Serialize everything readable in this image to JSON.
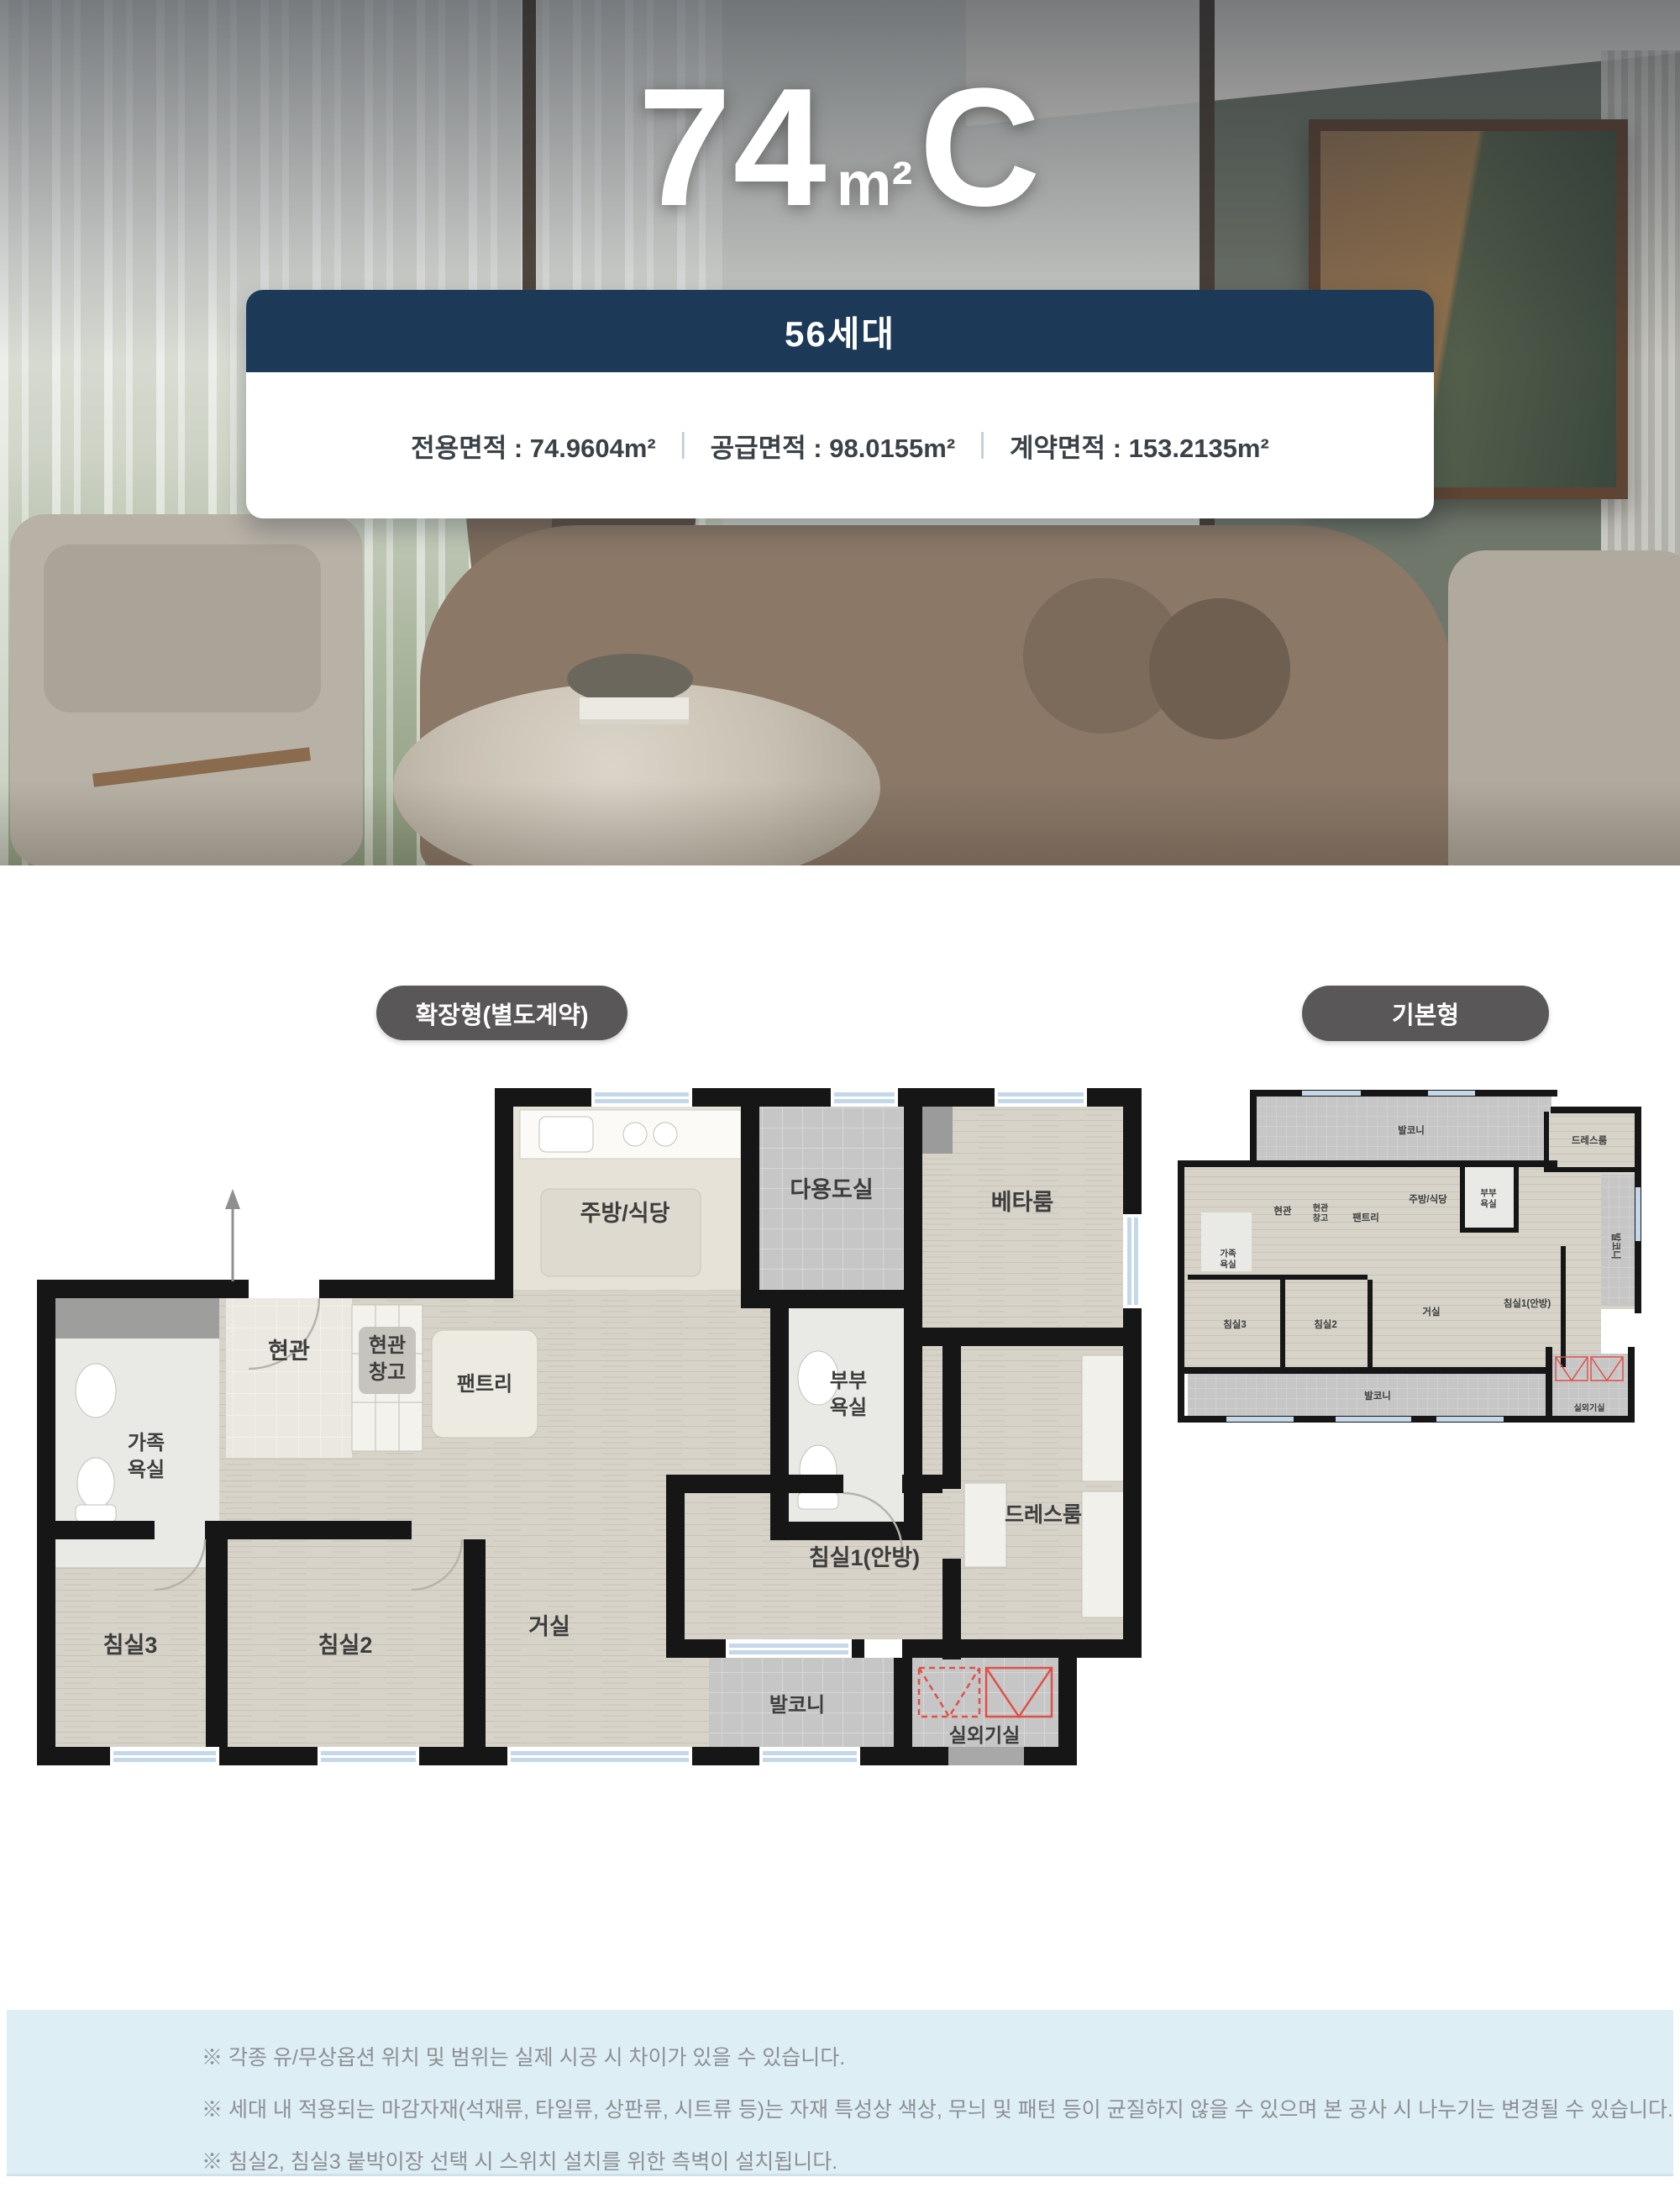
{
  "hero": {
    "unit_number": "74",
    "area_unit": "m²",
    "unit_letter": "C",
    "badge": "56세대",
    "area_exclusive": "전용면적 : 74.9604m²",
    "area_supply": "공급면적 : 98.0155m²",
    "area_contract": "계약면적 : 153.2135m²",
    "separator": "|"
  },
  "plans": {
    "expanded": {
      "badge": "확장형(별도계약)",
      "rooms": {
        "entry": "현관",
        "entry_storage_l1": "현관",
        "entry_storage_l2": "창고",
        "pantry": "팬트리",
        "family_bath_l1": "가족",
        "family_bath_l2": "욕실",
        "kitchen": "주방/식당",
        "utility": "다용도실",
        "beta_room": "베타룸",
        "master_bath_l1": "부부",
        "master_bath_l2": "욕실",
        "dress_room": "드레스룸",
        "bedroom1": "침실1(안방)",
        "living": "거실",
        "bedroom2": "침실2",
        "bedroom3": "침실3",
        "balcony": "발코니",
        "outdoor_unit": "실외기실"
      }
    },
    "basic": {
      "badge": "기본형",
      "rooms": {
        "balcony_top": "발코니",
        "dress_room": "드레스룸",
        "kitchen": "주방/식당",
        "master_bath_l1": "부부",
        "master_bath_l2": "욕실",
        "entry": "현관",
        "entry_storage_l1": "현관",
        "entry_storage_l2": "창고",
        "pantry": "팬트리",
        "family_bath_l1": "가족",
        "family_bath_l2": "욕실",
        "bedroom3": "침실3",
        "bedroom2": "침실2",
        "living": "거실",
        "bedroom1": "침실1(안방)",
        "balcony_right": "발코니",
        "balcony_bottom": "발코니",
        "outdoor_unit": "실외기실"
      }
    }
  },
  "notes": {
    "items": [
      "※ 각종 유/무상옵션 위치 및 범위는 실제 시공 시 차이가 있을 수 있습니다.",
      "※ 세대 내 적용되는 마감자재(석재류, 타일류, 상판류, 시트류 등)는 자재 특성상 색상, 무늬 및 패턴 등이 균질하지 않을 수 있으며 본 공사 시 나누기는 변경될 수 있습니다.",
      "※ 침실2, 침실3 붙박이장 선택 시 스위치 설치를 위한 측벽이 설치됩니다."
    ]
  },
  "colors": {
    "navy": "#1c3a58",
    "pill_gray": "#595757",
    "note_bg": "#ddeef5",
    "wall_black": "#161616",
    "window_blue": "#c5d8ea",
    "red_mark": "#df5148"
  }
}
